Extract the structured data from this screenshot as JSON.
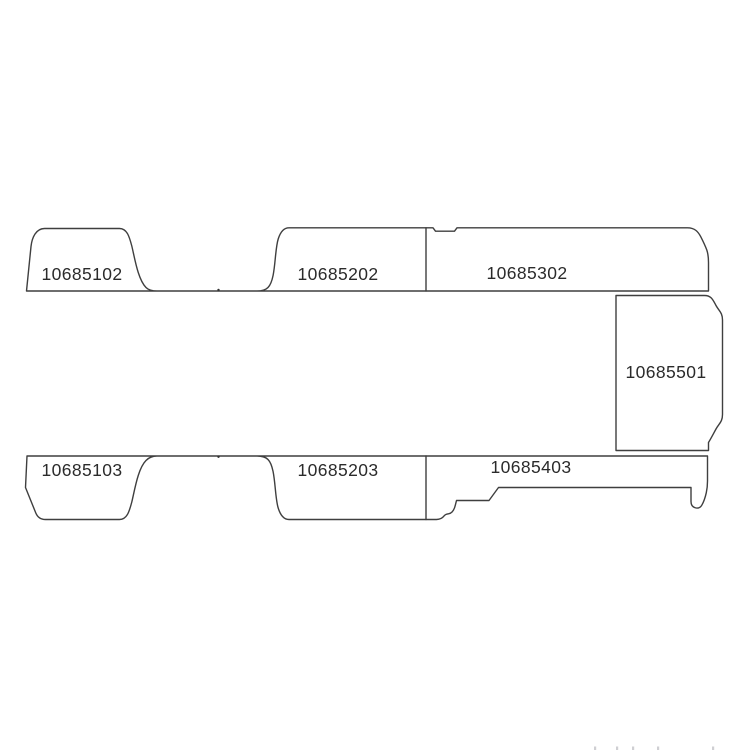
{
  "diagram": {
    "kind": "vehicle-trim-panel-parts-diagram",
    "colors": {
      "background": "#ffffff",
      "outline_stroke": "#3f3f3f",
      "label_text": "#2b2b2b"
    },
    "parts": [
      {
        "part_number": "10685102",
        "position": "top-row-left"
      },
      {
        "part_number": "10685202",
        "position": "top-row-middle"
      },
      {
        "part_number": "10685302",
        "position": "top-row-right"
      },
      {
        "part_number": "10685501",
        "position": "middle-right"
      },
      {
        "part_number": "10685103",
        "position": "bottom-row-left"
      },
      {
        "part_number": "10685203",
        "position": "bottom-row-middle"
      },
      {
        "part_number": "10685403",
        "position": "bottom-row-right"
      }
    ],
    "rows": {
      "top_row": [
        "10685102",
        "10685202",
        "10685302"
      ],
      "right_column": [
        "10685501"
      ],
      "bottom_row": [
        "10685103",
        "10685203",
        "10685403"
      ]
    }
  }
}
